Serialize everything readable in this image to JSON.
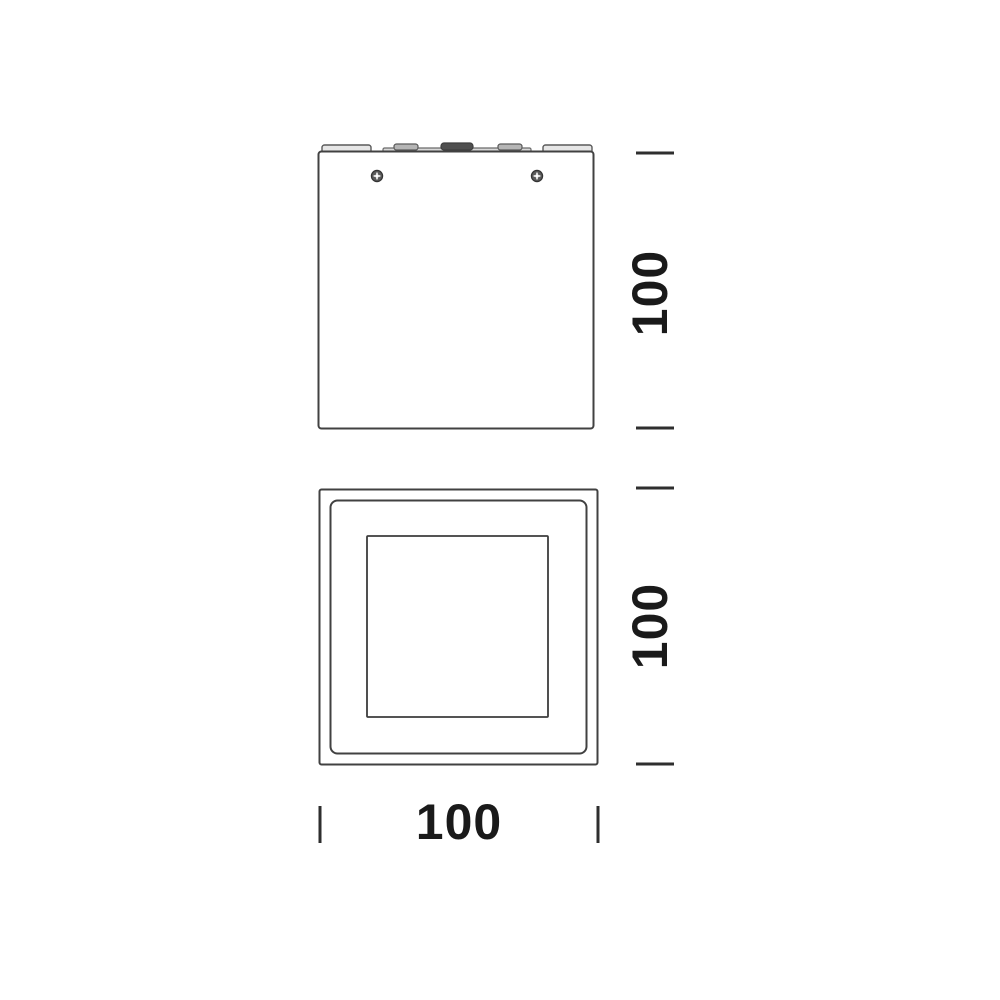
{
  "drawing": {
    "kind": "technical-dimension-drawing",
    "views": {
      "front_view": "fixture-front-elevation",
      "bottom_view": "fixture-bottom-face"
    }
  },
  "dimensions": {
    "front_height": "100",
    "bottom_height": "100",
    "bottom_width": "100"
  },
  "icons": {
    "screw_left": "phillips-screw-icon",
    "screw_right": "phillips-screw-icon"
  },
  "colors": {
    "background": "#ffffff",
    "line": "#414141",
    "tick": "#2e2e2e",
    "text": "#1a1a1a",
    "tab_dark": "#4f4f4f",
    "tab_light": "#e6e6e6",
    "tab_mid": "#b5b5b5",
    "rail": "#d8d8d8"
  }
}
